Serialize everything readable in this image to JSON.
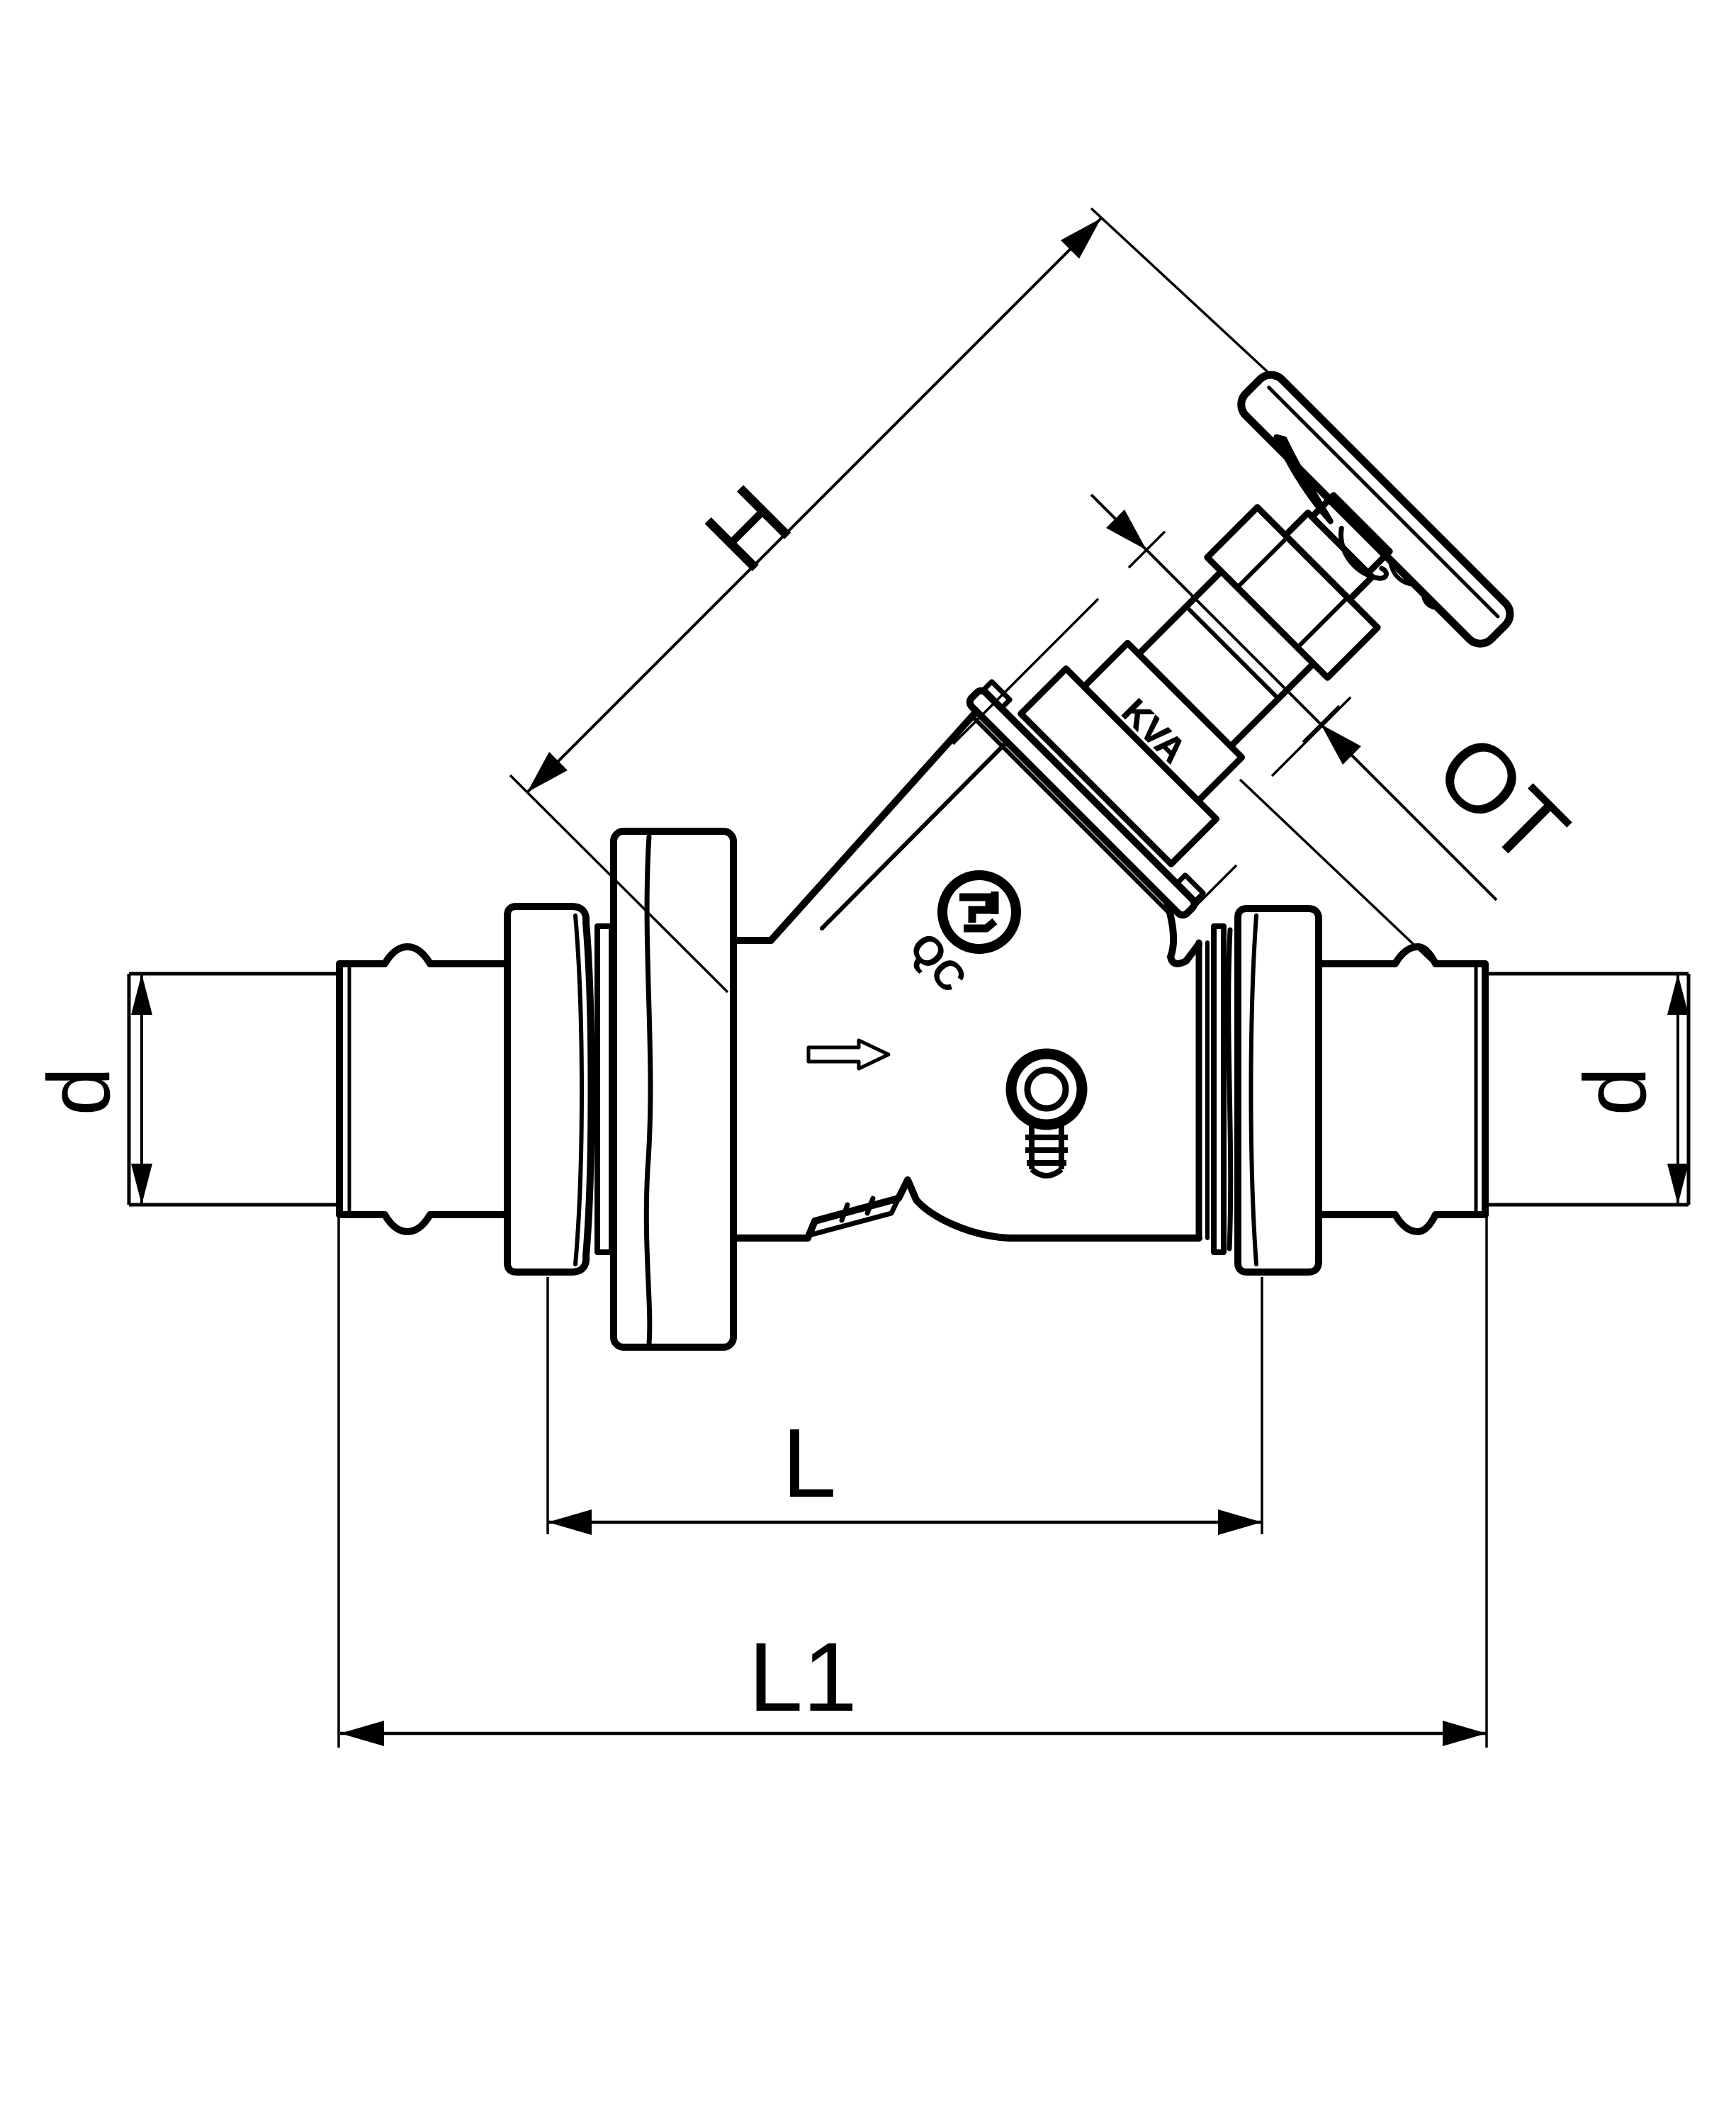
{
  "drawing": {
    "description": "Dimensional line drawing of an inclined-seat stop valve with press-fit pipe connections and angled handwheel",
    "ink_color": "#000000",
    "paper_color": "#ffffff"
  },
  "labels": {
    "height": "H",
    "top_part": "OT",
    "diameter_left": "d",
    "diameter_right": "d",
    "length_inner": "L",
    "length_overall": "L1"
  },
  "markings": {
    "bonnet_cast_mark": "KVA",
    "body_cast_mark": "QC"
  }
}
